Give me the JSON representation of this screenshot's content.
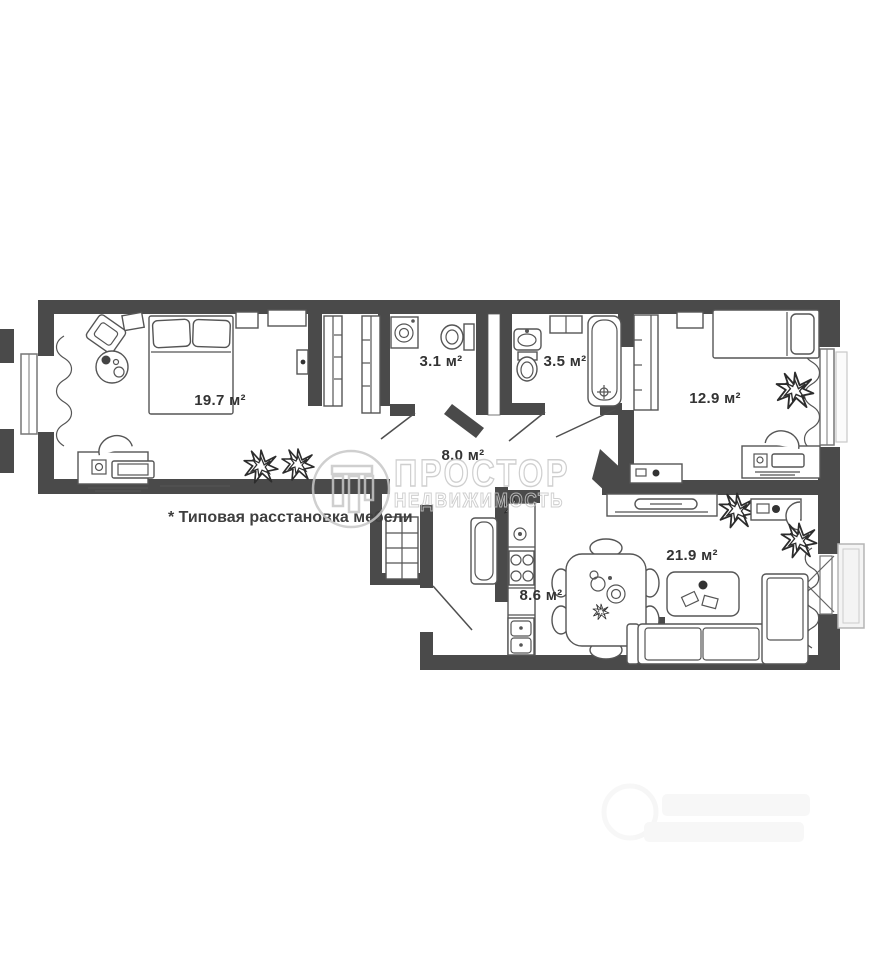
{
  "page": {
    "footnote": "* Типовая расстановка мебели"
  },
  "watermark": {
    "title": "ПРОСТОР",
    "subtitle": "НЕДВИЖИМОСТЬ"
  },
  "rooms": {
    "bedroom": {
      "area_label": "19.7 м²"
    },
    "bathroom_small": {
      "area_label": "3.1 м²"
    },
    "bathroom": {
      "area_label": "3.5 м²"
    },
    "bedroom2": {
      "area_label": "12.9 м²"
    },
    "hallway": {
      "area_label": "8.0 м²"
    },
    "kitchen": {
      "area_label": "8.6 м²"
    },
    "living_room": {
      "area_label": "21.9 м²"
    }
  },
  "colors": {
    "wall": "#4a4a4a",
    "furniture_line": "#555555",
    "label_text": "#333333",
    "watermark": "#c7c7c7",
    "footnote_text": "#3f3f3f"
  }
}
